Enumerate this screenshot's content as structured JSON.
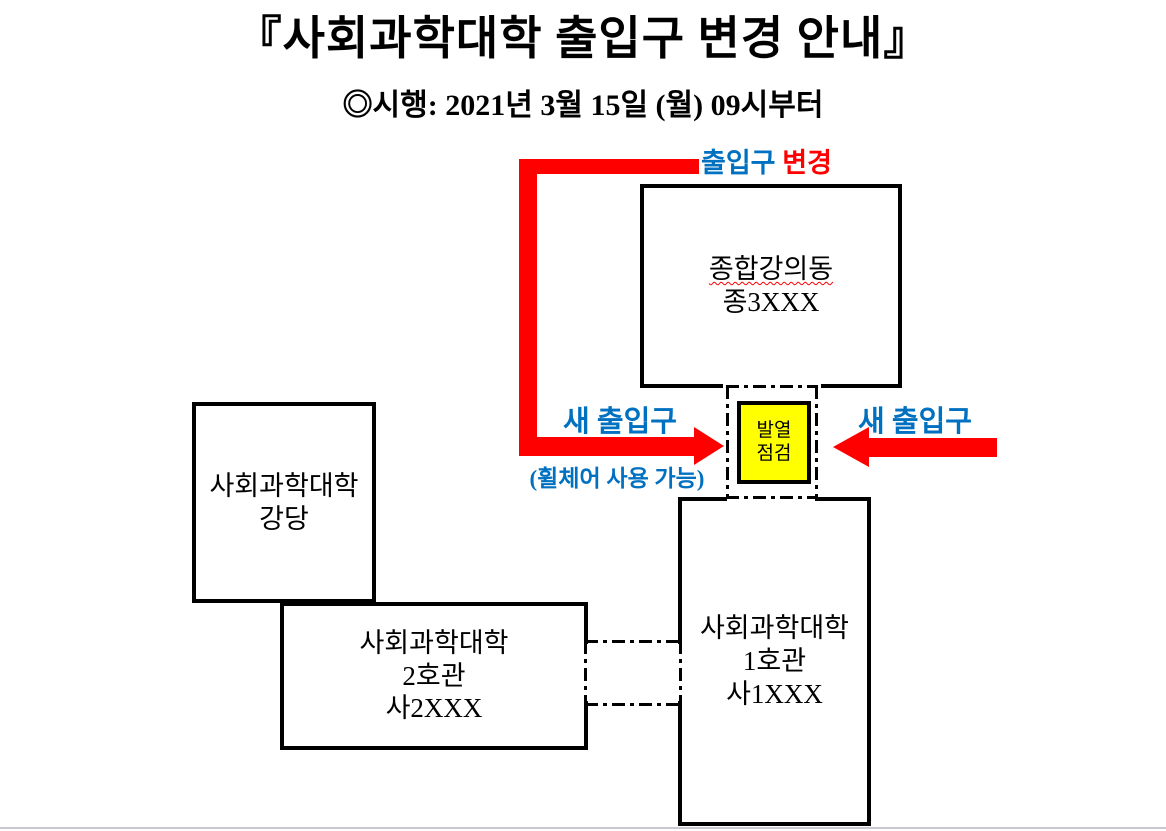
{
  "page": {
    "title": "『사회과학대학 출입구 변경 안내』",
    "subtitle": "◎시행: 2021년 3월 15일 (월) 09시부터"
  },
  "annotations": {
    "entrance_change": {
      "word_blue": "출입구",
      "word_red": "변경"
    },
    "new_entrance_left": "새 출입구",
    "new_entrance_right": "새 출입구",
    "wheelchair_note": "(휠체어 사용 가능)",
    "fever_check": {
      "line1": "발열",
      "line2": "점검"
    }
  },
  "buildings": {
    "lecture_hall": {
      "name": "종합강의동",
      "rooms": "종3XXX"
    },
    "auditorium": {
      "name": "사회과학대학",
      "sub": "강당"
    },
    "bldg2": {
      "name": "사회과학대학",
      "sub": "2호관",
      "rooms": "사2XXX"
    },
    "bldg1": {
      "name": "사회과학대학",
      "sub": "1호관",
      "rooms": "사1XXX"
    }
  },
  "colors": {
    "arrow_red": "#FF0000",
    "label_blue": "#0070C0",
    "fever_check_yellow": "#FFFF00",
    "bottom_rule_gray": "#C7C9CC"
  }
}
